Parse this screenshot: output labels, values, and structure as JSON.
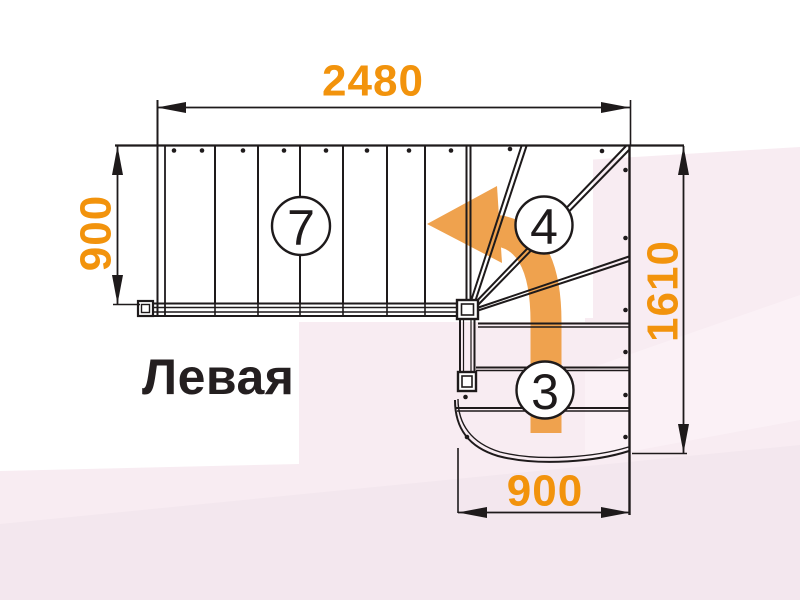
{
  "diagram": {
    "title": "Левая",
    "dimensions": {
      "top_width_mm": "2480",
      "left_depth_mm": "900",
      "right_height_mm": "1610",
      "bottom_width_mm": "900"
    },
    "step_counts": {
      "upper_flight": "7",
      "winder_turn": "4",
      "lower_flight": "3"
    }
  },
  "colors": {
    "dimension_text": "#f2930c",
    "turn_arrow": "#efa24e",
    "line": "#1e1a1b",
    "title_text": "#241f20",
    "badge_fill": "#ffffff",
    "bg_white": "#ffffff",
    "bg_pink": "#f8ecf2",
    "bg_pink_light": "#fbf1f6",
    "bg_pink_deep": "#f3e7ee"
  }
}
